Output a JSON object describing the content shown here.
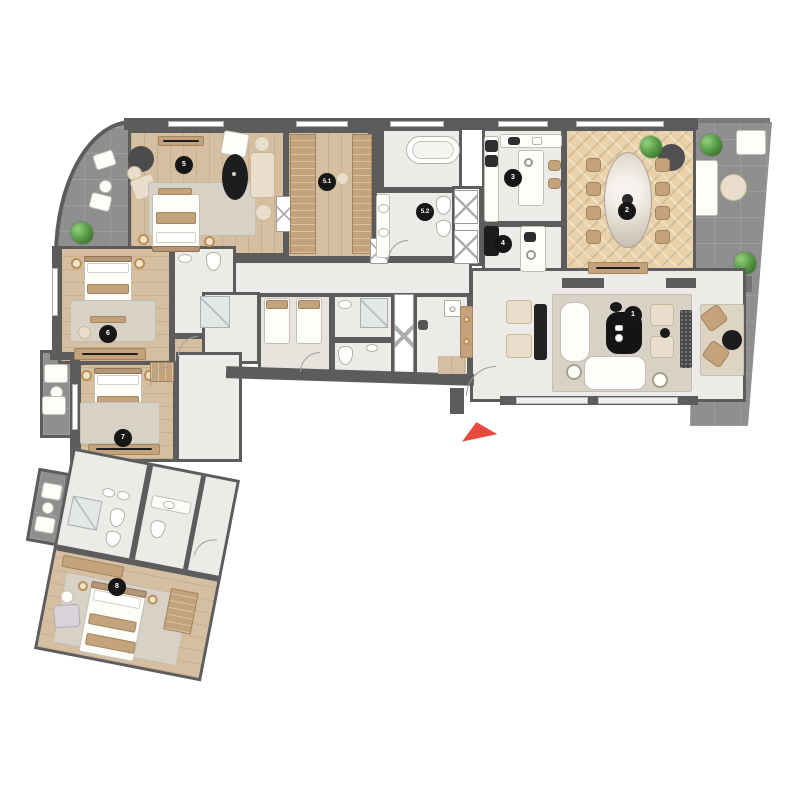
{
  "rooms": [
    {
      "label": "1"
    },
    {
      "label": "2"
    },
    {
      "label": "3"
    },
    {
      "label": "4"
    },
    {
      "label": "5"
    },
    {
      "label": "5.1"
    },
    {
      "label": "5.2"
    },
    {
      "label": "6"
    },
    {
      "label": "7"
    },
    {
      "label": "8"
    }
  ],
  "icons": {
    "entrance_arrow": "red triangle pointing up",
    "plant": "green foliage circle"
  },
  "colors": {
    "wall": "#5c5c5c",
    "wood": "#d6bfa0",
    "herring": "#e9d2ab",
    "marble": "#edebe7",
    "terrace": "#8f8f8f",
    "terraceDark": "#747474",
    "tan": "#c4a27c",
    "cream": "#e9decb",
    "rug": "#d7d2c5",
    "gold": "#bb8f56",
    "badgeBg": "#161616",
    "badgeText": "#ffffff",
    "accentRed": "#e8493f"
  }
}
